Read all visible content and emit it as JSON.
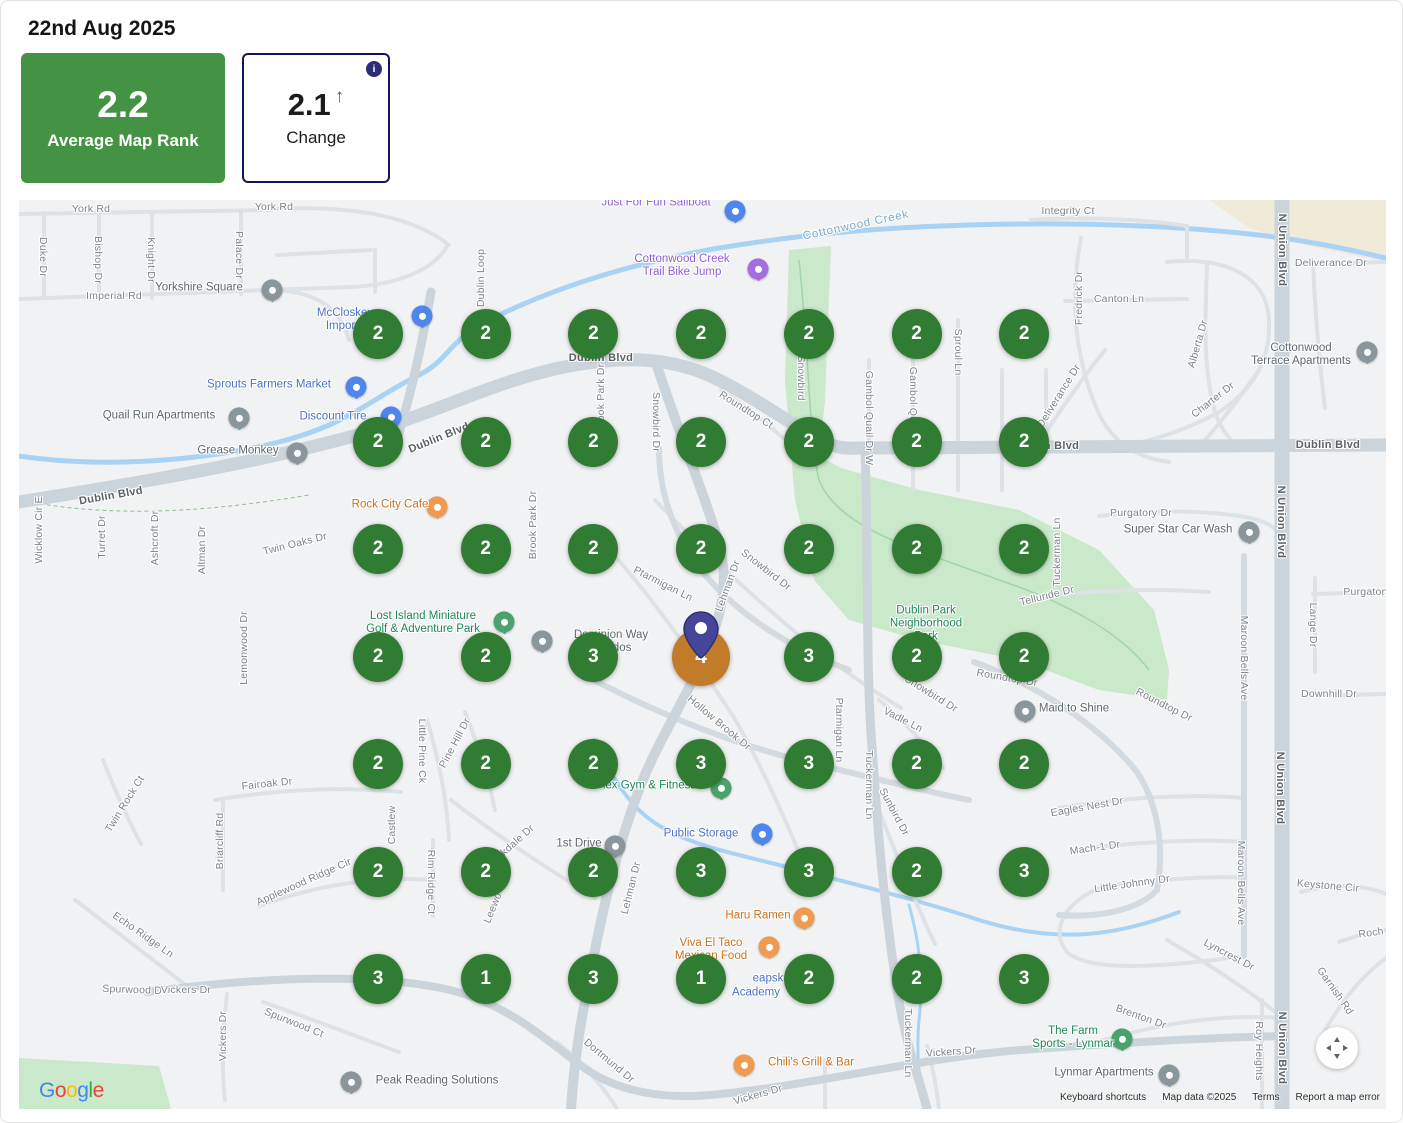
{
  "header": {
    "date": "22nd Aug 2025"
  },
  "cards": {
    "average": {
      "value": "2.2",
      "label": "Average Map Rank",
      "bg": "#449244"
    },
    "change": {
      "value": "2.1",
      "label": "Change",
      "direction": "up",
      "arrow": "↑",
      "info_icon": "i",
      "border": "#14145e",
      "arrow_color": "#2e7d32"
    }
  },
  "grid": {
    "rows": 7,
    "cols": 7,
    "origin_x": 359,
    "origin_y": 134,
    "dx": 107.7,
    "dy": 107.5,
    "marker_green": "#317c33",
    "marker_orange": "#c27b28",
    "center": {
      "row": 3,
      "col": 3
    },
    "values": [
      [
        "2",
        "2",
        "2",
        "2",
        "2",
        "2",
        "2"
      ],
      [
        "2",
        "2",
        "2",
        "2",
        "2",
        "2",
        "2"
      ],
      [
        "2",
        "2",
        "2",
        "2",
        "2",
        "2",
        "2"
      ],
      [
        "2",
        "2",
        "3",
        "4",
        "3",
        "2",
        "2"
      ],
      [
        "2",
        "2",
        "2",
        "3",
        "3",
        "2",
        "2"
      ],
      [
        "2",
        "2",
        "2",
        "3",
        "3",
        "2",
        "3"
      ],
      [
        "3",
        "1",
        "3",
        "1",
        "2",
        "2",
        "3"
      ]
    ]
  },
  "map": {
    "streets": [
      {
        "t": "York Rd",
        "x": 72,
        "y": 9
      },
      {
        "t": "York Rd",
        "x": 255,
        "y": 7
      },
      {
        "t": "Duke Dr",
        "x": 24,
        "y": 57,
        "v": "d"
      },
      {
        "t": "Bishop Dr",
        "x": 79,
        "y": 60,
        "v": "d"
      },
      {
        "t": "Knight Dr",
        "x": 132,
        "y": 60,
        "v": "d"
      },
      {
        "t": "Palace Dr",
        "x": 220,
        "y": 55,
        "v": "d"
      },
      {
        "t": "Imperial Rd",
        "x": 95,
        "y": 96
      },
      {
        "t": "Dublin Loop",
        "x": 462,
        "y": 78,
        "v": "u"
      },
      {
        "t": "Dublin Blvd",
        "x": 582,
        "y": 158,
        "m": true
      },
      {
        "t": "Dublin Blvd",
        "x": 420,
        "y": 238,
        "r": -22,
        "m": true
      },
      {
        "t": "Dublin Blvd",
        "x": 92,
        "y": 296,
        "r": -10,
        "m": true
      },
      {
        "t": "Dublin Blvd",
        "x": 1309,
        "y": 245,
        "m": true
      },
      {
        "t": "Dublin Blvd",
        "x": 1028,
        "y": 246,
        "m": true
      },
      {
        "t": "Wicklow Cir E",
        "x": 20,
        "y": 330,
        "v": "u"
      },
      {
        "t": "Turret Dr",
        "x": 83,
        "y": 337,
        "v": "u"
      },
      {
        "t": "Ashcroft Dr",
        "x": 136,
        "y": 338,
        "v": "u"
      },
      {
        "t": "Altman Dr",
        "x": 183,
        "y": 350,
        "v": "u"
      },
      {
        "t": "Twin Oaks Dr",
        "x": 276,
        "y": 344,
        "r": -14
      },
      {
        "t": "Lemonwood Dr",
        "x": 225,
        "y": 448,
        "v": "u"
      },
      {
        "t": "Brook Park Dr",
        "x": 514,
        "y": 325,
        "v": "u"
      },
      {
        "t": "Brook Park Dr",
        "x": 582,
        "y": 198,
        "v": "u"
      },
      {
        "t": "Snowbird Dr",
        "x": 637,
        "y": 222,
        "v": "d"
      },
      {
        "t": "Snowbird",
        "x": 782,
        "y": 178,
        "v": "d"
      },
      {
        "t": "Roundtop Ct",
        "x": 727,
        "y": 210,
        "r": 32
      },
      {
        "t": "Gambol Quail Dr W",
        "x": 850,
        "y": 218,
        "v": "d"
      },
      {
        "t": "Gambol Quail",
        "x": 894,
        "y": 200,
        "v": "d"
      },
      {
        "t": "Sproul Ln",
        "x": 939,
        "y": 152,
        "v": "d"
      },
      {
        "t": "Fredrick Dr",
        "x": 1060,
        "y": 98,
        "v": "u"
      },
      {
        "t": "Canton Ln",
        "x": 1100,
        "y": 99
      },
      {
        "t": "Integrity Ct",
        "x": 1049,
        "y": 11
      },
      {
        "t": "Deliverance Dr",
        "x": 1312,
        "y": 63
      },
      {
        "t": "Deliverance Dr",
        "x": 1040,
        "y": 196,
        "r": -58
      },
      {
        "t": "Alberta Dr",
        "x": 1179,
        "y": 144,
        "r": -74
      },
      {
        "t": "Charter Dr",
        "x": 1194,
        "y": 200,
        "r": -38
      },
      {
        "t": "N Union Blvd",
        "x": 1263,
        "y": 50,
        "v": "d",
        "m": true
      },
      {
        "t": "N Union Blvd",
        "x": 1262,
        "y": 322,
        "v": "d",
        "m": true
      },
      {
        "t": "N Union Blvd",
        "x": 1261,
        "y": 588,
        "v": "d",
        "m": true
      },
      {
        "t": "N Union Blvd",
        "x": 1263,
        "y": 848,
        "v": "d",
        "m": true
      },
      {
        "t": "Purgatory Dr",
        "x": 1122,
        "y": 313
      },
      {
        "t": "Purgatory",
        "x": 1348,
        "y": 392
      },
      {
        "t": "Telluride Dr",
        "x": 1028,
        "y": 396,
        "r": -14
      },
      {
        "t": "Tuckerman Ln",
        "x": 1038,
        "y": 352,
        "v": "u"
      },
      {
        "t": "Lange Dr",
        "x": 1294,
        "y": 425,
        "v": "d"
      },
      {
        "t": "Maroon Bells Ave",
        "x": 1225,
        "y": 458,
        "v": "d"
      },
      {
        "t": "Maroon Bells Ave",
        "x": 1222,
        "y": 683,
        "v": "d"
      },
      {
        "t": "Downhill Dr",
        "x": 1310,
        "y": 494
      },
      {
        "t": "Roundtop Dr",
        "x": 1145,
        "y": 505,
        "r": 27
      },
      {
        "t": "Roundtop Dr",
        "x": 988,
        "y": 478,
        "r": 10
      },
      {
        "t": "Snowbird Dr",
        "x": 747,
        "y": 370,
        "r": 38
      },
      {
        "t": "Lehman Dr",
        "x": 709,
        "y": 386,
        "r": -70
      },
      {
        "t": "Ptarmigan Ln",
        "x": 644,
        "y": 384,
        "r": 27
      },
      {
        "t": "Ptarmigan Ln",
        "x": 820,
        "y": 530,
        "v": "d"
      },
      {
        "t": "Snowbird Dr",
        "x": 912,
        "y": 494,
        "r": 32
      },
      {
        "t": "Vadle Ln",
        "x": 884,
        "y": 520,
        "r": 27
      },
      {
        "t": "Hollow Brook Dr",
        "x": 700,
        "y": 523,
        "r": 40
      },
      {
        "t": "Tuckerman Ln",
        "x": 850,
        "y": 585,
        "v": "d"
      },
      {
        "t": "Sunbird Dr",
        "x": 875,
        "y": 612,
        "r": 62
      },
      {
        "t": "Little Pine Ck",
        "x": 403,
        "y": 551,
        "v": "d"
      },
      {
        "t": "Pine Hill Dr",
        "x": 436,
        "y": 543,
        "r": -62
      },
      {
        "t": "Fairoak Dr",
        "x": 248,
        "y": 584,
        "r": -6
      },
      {
        "t": "Twin Rock Ct",
        "x": 106,
        "y": 604,
        "r": -58
      },
      {
        "t": "Briarcliff Rd",
        "x": 201,
        "y": 641,
        "v": "u"
      },
      {
        "t": "Castlew",
        "x": 373,
        "y": 625,
        "v": "u"
      },
      {
        "t": "Applewood Ridge Cir",
        "x": 285,
        "y": 682,
        "r": -24
      },
      {
        "t": "Rim Ridge Ct",
        "x": 412,
        "y": 682,
        "v": "d"
      },
      {
        "t": "Brookdale Dr",
        "x": 490,
        "y": 648,
        "r": -42
      },
      {
        "t": "Leewo",
        "x": 474,
        "y": 708,
        "r": -68
      },
      {
        "t": "Lehman Dr",
        "x": 612,
        "y": 688,
        "r": -76
      },
      {
        "t": "Echo Ridge Ln",
        "x": 124,
        "y": 735,
        "r": 35
      },
      {
        "t": "Spurwood Dr",
        "x": 115,
        "y": 790,
        "r": 2
      },
      {
        "t": "Vickers Dr",
        "x": 204,
        "y": 836,
        "v": "u"
      },
      {
        "t": "Spurwood Ct",
        "x": 275,
        "y": 823,
        "r": 22
      },
      {
        "t": "Vickers Dr",
        "x": 167,
        "y": 790
      },
      {
        "t": "Eagles Nest Dr",
        "x": 1068,
        "y": 607,
        "r": -10
      },
      {
        "t": "Mach-1 Dr",
        "x": 1076,
        "y": 648,
        "r": -8
      },
      {
        "t": "Little Johnny Dr",
        "x": 1113,
        "y": 684,
        "r": -8
      },
      {
        "t": "Keystone Cir",
        "x": 1309,
        "y": 686,
        "r": 5
      },
      {
        "t": "Roch",
        "x": 1352,
        "y": 733,
        "r": -8
      },
      {
        "t": "Garnish Rd",
        "x": 1316,
        "y": 791,
        "r": 55
      },
      {
        "t": "Lyncrest Dr",
        "x": 1210,
        "y": 755,
        "r": 28
      },
      {
        "t": "Brenton Dr",
        "x": 1122,
        "y": 817,
        "r": 20
      },
      {
        "t": "Tuckerman Ln",
        "x": 889,
        "y": 843,
        "v": "d"
      },
      {
        "t": "Roy Heights",
        "x": 1240,
        "y": 851,
        "v": "d"
      },
      {
        "t": "Vickers Dr",
        "x": 932,
        "y": 852,
        "r": -4
      },
      {
        "t": "Vickers Dr",
        "x": 739,
        "y": 895,
        "r": -16
      },
      {
        "t": "Dortmund Dr",
        "x": 590,
        "y": 861,
        "r": 40
      }
    ],
    "pois": [
      {
        "n": "yorkshire-square",
        "lines": [
          "Yorkshire Square"
        ],
        "c": "gray",
        "x": 180,
        "y": 88,
        "icon": {
          "x": 253,
          "y": 92
        }
      },
      {
        "n": "mccloskey-imports",
        "lines": [
          "McCloskey",
          "Imports"
        ],
        "c": "blue",
        "x": 326,
        "y": 120,
        "icon": {
          "x": 403,
          "y": 118,
          "c": "blue"
        }
      },
      {
        "n": "sprouts-farmers-market",
        "lines": [
          "Sprouts Farmers Market"
        ],
        "c": "blue",
        "x": 250,
        "y": 185,
        "icon": {
          "x": 337,
          "y": 189,
          "c": "blue"
        }
      },
      {
        "n": "quail-run-apartments",
        "lines": [
          "Quail Run Apartments"
        ],
        "c": "gray",
        "x": 140,
        "y": 216,
        "icon": {
          "x": 220,
          "y": 220
        }
      },
      {
        "n": "discount-tire",
        "lines": [
          "Discount Tire"
        ],
        "c": "blue",
        "x": 314,
        "y": 217,
        "icon": {
          "x": 372,
          "y": 219,
          "c": "blue"
        }
      },
      {
        "n": "grease-monkey",
        "lines": [
          "Grease Monkey"
        ],
        "c": "gray",
        "x": 219,
        "y": 251,
        "icon": {
          "x": 278,
          "y": 255
        }
      },
      {
        "n": "rock-city-cafe",
        "lines": [
          "Rock City Cafe"
        ],
        "c": "orange",
        "x": 371,
        "y": 305,
        "icon": {
          "x": 418,
          "y": 309,
          "c": "orange"
        }
      },
      {
        "n": "just-for-fun-sailboat",
        "lines": [
          "Just For Fun Sailboat"
        ],
        "c": "purple",
        "x": 637,
        "y": 3,
        "icon": {
          "x": 716,
          "y": 13,
          "c": "blue"
        }
      },
      {
        "n": "cottonwood-creek",
        "lines": [
          "Cottonwood Creek"
        ],
        "c": "water",
        "x": 837,
        "y": 26,
        "r": -12
      },
      {
        "n": "cottonwood-creek-trail-bike-jump",
        "lines": [
          "Cottonwood Creek",
          "Trail Bike Jump"
        ],
        "c": "purple",
        "x": 663,
        "y": 66,
        "icon": {
          "x": 739,
          "y": 71,
          "c": "purple"
        }
      },
      {
        "n": "cottonwood-terrace-apartments",
        "lines": [
          "Cottonwood",
          "Terrace Apartments"
        ],
        "c": "gray",
        "x": 1282,
        "y": 155,
        "icon": {
          "x": 1348,
          "y": 154
        }
      },
      {
        "n": "super-star-car-wash",
        "lines": [
          "Super Star Car Wash"
        ],
        "c": "gray",
        "x": 1159,
        "y": 330,
        "icon": {
          "x": 1230,
          "y": 334
        }
      },
      {
        "n": "lost-island-miniature-golf",
        "lines": [
          "Lost Island Miniature",
          "Golf & Adventure Park"
        ],
        "c": "green",
        "x": 404,
        "y": 423,
        "icon": {
          "x": 485,
          "y": 424,
          "c": "green"
        }
      },
      {
        "n": "dominion-way-condos",
        "lines": [
          "Dominion Way",
          "off...dos"
        ],
        "c": "gray",
        "x": 592,
        "y": 442,
        "icon": {
          "x": 523,
          "y": 443
        }
      },
      {
        "n": "dublin-park-neighborhood-park",
        "lines": [
          "Dublin Park",
          "Neighborhood",
          "Park"
        ],
        "c": "green",
        "x": 907,
        "y": 424
      },
      {
        "n": "maid-to-shine",
        "lines": [
          "Maid to Shine"
        ],
        "c": "gray",
        "x": 1055,
        "y": 509,
        "icon": {
          "x": 1006,
          "y": 513
        }
      },
      {
        "n": "flex-gym-fitness",
        "lines": [
          "Flex Gym & Fitness"
        ],
        "c": "green",
        "x": 627,
        "y": 586,
        "icon": {
          "x": 702,
          "y": 590,
          "c": "green"
        }
      },
      {
        "n": "public-storage",
        "lines": [
          "Public Storage"
        ],
        "c": "blue",
        "x": 682,
        "y": 634,
        "icon": {
          "x": 743,
          "y": 636,
          "c": "blue"
        }
      },
      {
        "n": "first-drive",
        "lines": [
          "1st Drive"
        ],
        "c": "gray",
        "x": 560,
        "y": 644,
        "icon": {
          "x": 596,
          "y": 648
        }
      },
      {
        "n": "haru-ramen",
        "lines": [
          "Haru Ramen"
        ],
        "c": "orange",
        "x": 739,
        "y": 716,
        "icon": {
          "x": 785,
          "y": 720,
          "c": "orange"
        }
      },
      {
        "n": "viva-el-taco",
        "lines": [
          "Viva El Taco",
          "Mexican Food"
        ],
        "c": "orange",
        "x": 692,
        "y": 750,
        "icon": {
          "x": 750,
          "y": 749,
          "c": "orange"
        }
      },
      {
        "n": "cheapskate-academy-part1",
        "lines": [
          "Up"
        ],
        "c": "blue",
        "x": 668,
        "y": 779
      },
      {
        "n": "cheapskate-academy-part2",
        "lines": [
          "eapskate"
        ],
        "c": "blue",
        "x": 757,
        "y": 779
      },
      {
        "n": "cheapskate-academy-part3",
        "lines": [
          "Academy"
        ],
        "c": "blue",
        "x": 737,
        "y": 793
      },
      {
        "n": "chilis-grill-bar",
        "lines": [
          "Chili's Grill & Bar"
        ],
        "c": "orange",
        "x": 792,
        "y": 863,
        "icon": {
          "x": 725,
          "y": 867,
          "c": "orange"
        }
      },
      {
        "n": "peak-reading-solutions",
        "lines": [
          "Peak Reading Solutions"
        ],
        "c": "gray",
        "x": 418,
        "y": 881,
        "icon": {
          "x": 332,
          "y": 884
        }
      },
      {
        "n": "the-farm-sports-lynmar",
        "lines": [
          "The Farm",
          "Sports - Lynmar"
        ],
        "c": "green",
        "x": 1054,
        "y": 838,
        "icon": {
          "x": 1103,
          "y": 841,
          "c": "green"
        }
      },
      {
        "n": "lynmar-apartments",
        "lines": [
          "Lynmar Apartments"
        ],
        "c": "gray",
        "x": 1085,
        "y": 873,
        "icon": {
          "x": 1150,
          "y": 877
        }
      }
    ],
    "google_logo": {
      "text": "Google",
      "colors": [
        "#4285F4",
        "#EA4335",
        "#FBBC05",
        "#4285F4",
        "#34A853",
        "#EA4335"
      ]
    },
    "attribution": {
      "keyboard": "Keyboard shortcuts",
      "mapdata": "Map data ©2025",
      "terms": "Terms",
      "report": "Report a map error"
    }
  }
}
